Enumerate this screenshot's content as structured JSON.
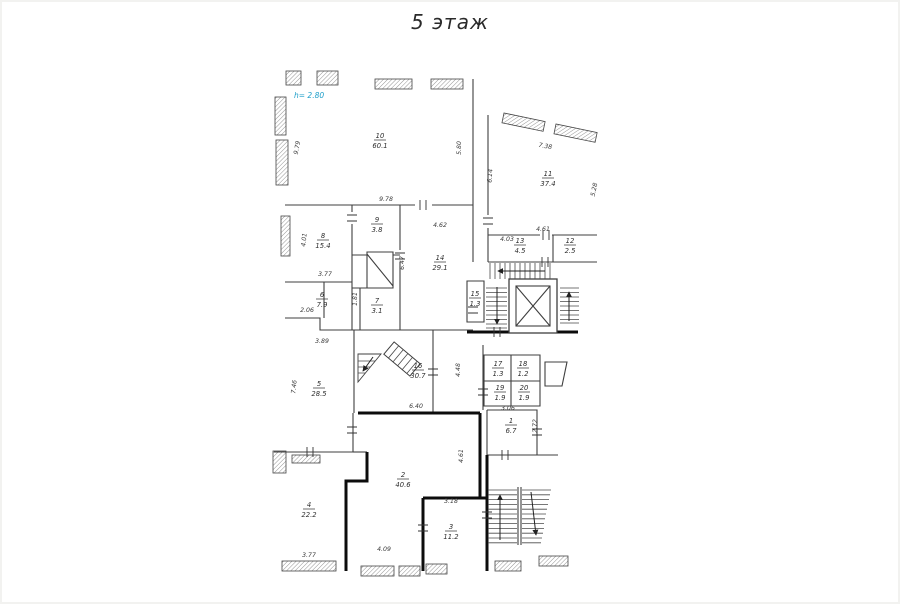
{
  "title": "5 этаж",
  "height_note": {
    "text": "h= 2.80",
    "color": "#1d9ec9"
  },
  "plan": {
    "rooms": [
      {
        "num": "10",
        "area": "60.1",
        "x": 380,
        "y": 138
      },
      {
        "num": "11",
        "area": "37.4",
        "x": 548,
        "y": 176
      },
      {
        "num": "8",
        "area": "15.4",
        "x": 323,
        "y": 238
      },
      {
        "num": "9",
        "area": "3.8",
        "x": 377,
        "y": 222
      },
      {
        "num": "14",
        "area": "29.1",
        "x": 440,
        "y": 260
      },
      {
        "num": "13",
        "area": "4.5",
        "x": 520,
        "y": 243
      },
      {
        "num": "12",
        "area": "2.5",
        "x": 570,
        "y": 243
      },
      {
        "num": "6",
        "area": "7.9",
        "x": 322,
        "y": 297
      },
      {
        "num": "7",
        "area": "3.1",
        "x": 377,
        "y": 303
      },
      {
        "num": "15",
        "area": "1.3",
        "x": 475,
        "y": 296
      },
      {
        "num": "5",
        "area": "28.5",
        "x": 319,
        "y": 386
      },
      {
        "num": "16",
        "area": "30.7",
        "x": 418,
        "y": 368
      },
      {
        "num": "17",
        "area": "1.3",
        "x": 498,
        "y": 366
      },
      {
        "num": "18",
        "area": "1.2",
        "x": 523,
        "y": 366
      },
      {
        "num": "19",
        "area": "1.9",
        "x": 500,
        "y": 390
      },
      {
        "num": "20",
        "area": "1.9",
        "x": 524,
        "y": 390
      },
      {
        "num": "1",
        "area": "6.7",
        "x": 511,
        "y": 423
      },
      {
        "num": "2",
        "area": "40.6",
        "x": 403,
        "y": 477
      },
      {
        "num": "3",
        "area": "11.2",
        "x": 451,
        "y": 529
      },
      {
        "num": "4",
        "area": "22.2",
        "x": 309,
        "y": 507
      }
    ],
    "dimensions": [
      {
        "t": "9.79",
        "x": 299,
        "y": 148,
        "r": -80
      },
      {
        "t": "5.80",
        "x": 461,
        "y": 148,
        "r": -90
      },
      {
        "t": "9.78",
        "x": 386,
        "y": 201,
        "r": 0
      },
      {
        "t": "7.38",
        "x": 545,
        "y": 148,
        "r": 10
      },
      {
        "t": "5.28",
        "x": 596,
        "y": 190,
        "r": -78
      },
      {
        "t": "6.14",
        "x": 492,
        "y": 176,
        "r": -86
      },
      {
        "t": "4.03",
        "x": 507,
        "y": 241,
        "r": 0
      },
      {
        "t": "4.61",
        "x": 543,
        "y": 231,
        "r": 0
      },
      {
        "t": "4.62",
        "x": 440,
        "y": 227,
        "r": 0
      },
      {
        "t": "6.47",
        "x": 404,
        "y": 263,
        "r": -90
      },
      {
        "t": "4.01",
        "x": 306,
        "y": 240,
        "r": -84
      },
      {
        "t": "3.77",
        "x": 325,
        "y": 276,
        "r": 0
      },
      {
        "t": "2.06",
        "x": 307,
        "y": 312,
        "r": 0
      },
      {
        "t": "1.81",
        "x": 357,
        "y": 299,
        "r": -90
      },
      {
        "t": "3.89",
        "x": 322,
        "y": 343,
        "r": 0
      },
      {
        "t": "7.46",
        "x": 296,
        "y": 387,
        "r": -84
      },
      {
        "t": "4.48",
        "x": 460,
        "y": 370,
        "r": -90
      },
      {
        "t": "6.40",
        "x": 416,
        "y": 408,
        "r": 0
      },
      {
        "t": "3.06",
        "x": 508,
        "y": 410,
        "r": 0
      },
      {
        "t": "2.72",
        "x": 537,
        "y": 426,
        "r": -90
      },
      {
        "t": "4.61",
        "x": 463,
        "y": 456,
        "r": -90
      },
      {
        "t": "3.18",
        "x": 451,
        "y": 503,
        "r": 0
      },
      {
        "t": "4.09",
        "x": 384,
        "y": 551,
        "r": 0
      },
      {
        "t": "3.77",
        "x": 309,
        "y": 557,
        "r": 0
      }
    ],
    "features": [
      "elevator-shaft",
      "upper-stairwell",
      "lower-stairwell",
      "spiral-stair",
      "corner-stair"
    ]
  }
}
